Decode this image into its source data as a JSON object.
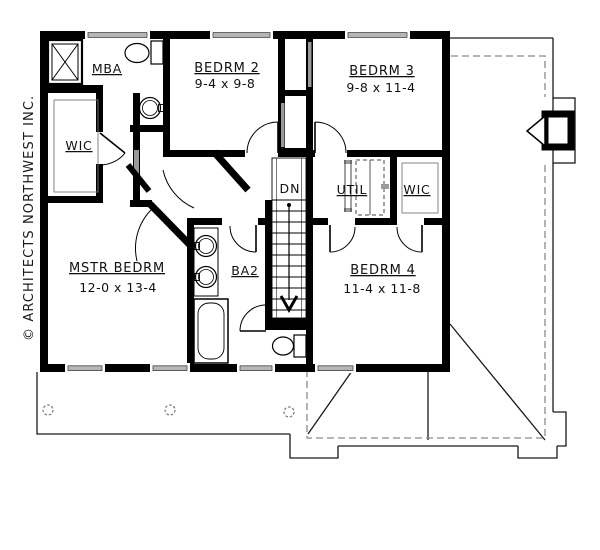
{
  "plan": {
    "copyright": "© ARCHITECTS NORTHWEST INC.",
    "labels": {
      "mba": "MBA",
      "wic_left": "WIC",
      "bedrm2": "BEDRM 2",
      "bedrm2_dims": "9-4 x 9-8",
      "bedrm3": "BEDRM 3",
      "bedrm3_dims": "9-8 x 11-4",
      "util": "UTIL",
      "wic_right": "WIC",
      "dn": "DN",
      "mstr": "MSTR BEDRM",
      "mstr_dims": "12-0 x 13-4",
      "ba2": "BA2",
      "bedrm4": "BEDRM 4",
      "bedrm4_dims": "11-4 x 11-8"
    },
    "colors": {
      "wall": "#000000",
      "window_fill": "#b5b5b5",
      "roof_dash": "#8a8a8a",
      "paper": "#ffffff"
    }
  }
}
